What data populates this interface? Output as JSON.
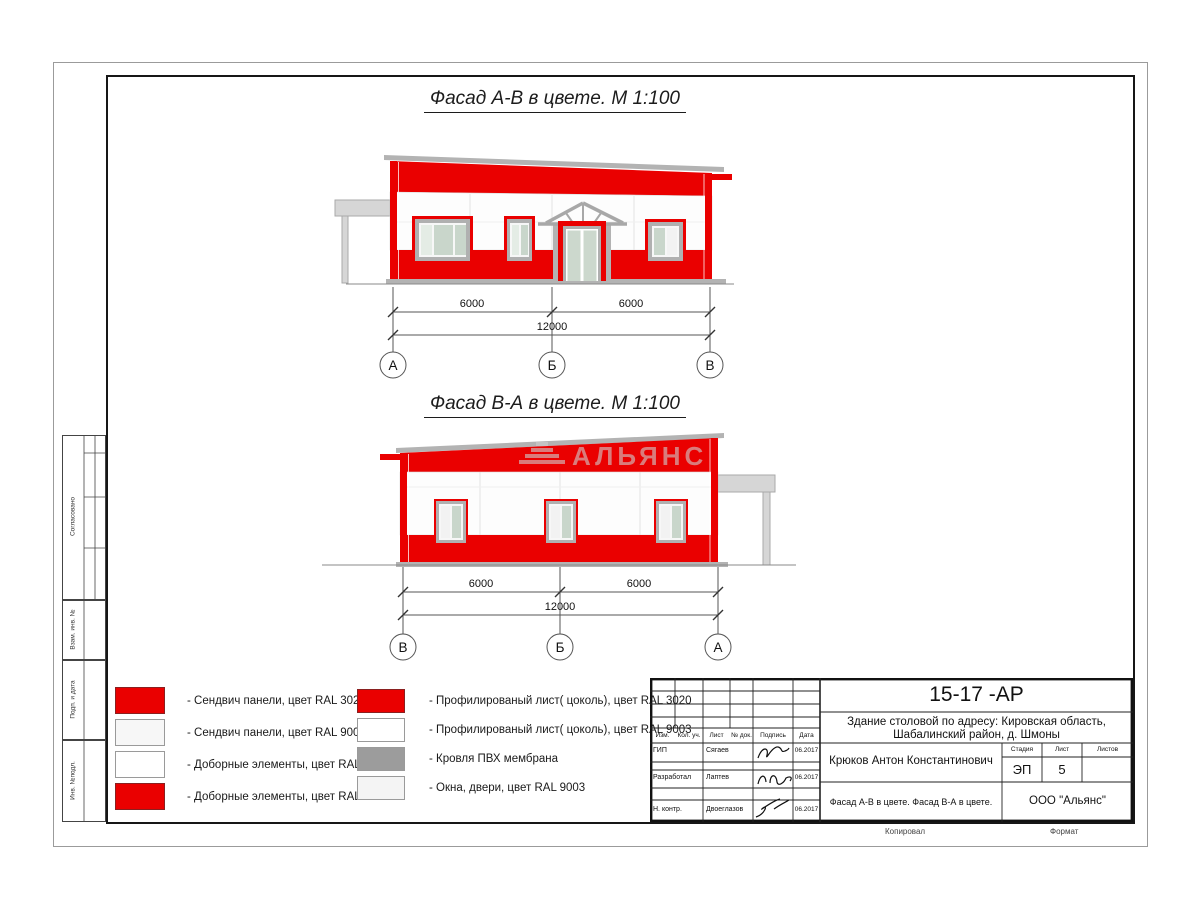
{
  "colors": {
    "red": "#ea0000",
    "glass": "#c9d6cb",
    "frame_gray": "#b0b0b0",
    "roof_gray": "#b3b3b3",
    "canopy_gray": "#d6d6d6"
  },
  "facade_ab": {
    "title": "Фасад А-В в цвете.  М 1:100",
    "dim_left": "6000",
    "dim_right": "6000",
    "dim_total": "12000",
    "axes": [
      "А",
      "Б",
      "В"
    ]
  },
  "facade_ba": {
    "title": "Фасад В-А в цвете.  М 1:100",
    "dim_left": "6000",
    "dim_right": "6000",
    "dim_total": "12000",
    "axes": [
      "В",
      "Б",
      "А"
    ],
    "watermark": "АЛЬЯНС"
  },
  "legend": {
    "left": [
      {
        "color": "#ea0000",
        "label": "- Сендвич панели, цвет RAL 3020"
      },
      {
        "color": "#f7f7f7",
        "label": "- Сендвич панели, цвет RAL 9003"
      },
      {
        "color": "#ffffff",
        "label": "- Доборные элементы, цвет RAL 9003"
      },
      {
        "color": "#ea0000",
        "label": "- Доборные элементы, цвет RAL 3020"
      }
    ],
    "right": [
      {
        "color": "#ea0000",
        "label": "- Профилированый лист( цоколь), цвет RAL 3020"
      },
      {
        "color": "#ffffff",
        "label": "- Профилированый лист( цоколь), цвет RAL 9003"
      },
      {
        "color": "#9c9c9c",
        "label": "- Кровля ПВХ мембрана"
      },
      {
        "color": "#f4f4f4",
        "label": "- Окна, двери, цвет RAL 9003"
      }
    ]
  },
  "stamp": {
    "doc_number": "15-17 -АР",
    "object_line1": "Здание столовой по адресу: Кировская область,",
    "object_line2": "Шабалинский район, д. Шмоны",
    "header": {
      "izm": "Изм.",
      "kol": "Кол. уч.",
      "list": "Лист",
      "ndok": "№ док.",
      "sign": "Подпись",
      "date": "Дата"
    },
    "rows": [
      {
        "role": "ГИП",
        "name": "Сягаев",
        "date": "06.2017"
      },
      {
        "role": "Разработал",
        "name": "Лаптев",
        "date": "06.2017"
      },
      {
        "role": "Н. контр.",
        "name": "Двоеглазов",
        "date": "06.2017"
      }
    ],
    "author": "Крюков Антон Константинович",
    "stage_cols": [
      "Стадия",
      "Лист",
      "Листов"
    ],
    "stage": "ЭП",
    "sheet": "5",
    "sheets_total": "",
    "sheet_title": "Фасад А-В в цвете. Фасад В-А в цвете.",
    "company": "ООО \"Альянс\"",
    "copied_label": "Копировал",
    "format_label": "Формат"
  },
  "sidebar": {
    "agreed": "Согласовано",
    "replace_inv": "Взам. инв. №",
    "sign_date": "Подп. и дата",
    "inv_orig": "Инв. №подл."
  }
}
